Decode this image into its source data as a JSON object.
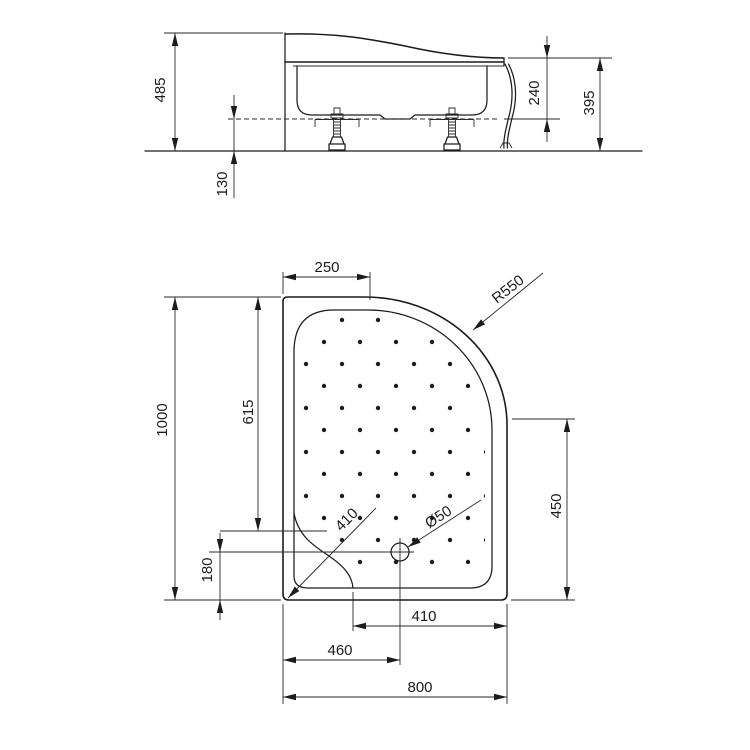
{
  "colors": {
    "line": "#1c1c1c",
    "background": "#ffffff"
  },
  "side_view": {
    "dim_overall_height": "485",
    "dim_rim_to_base": "240",
    "dim_apron_height": "395",
    "dim_floor_clearance": "130"
  },
  "plan_view": {
    "dim_top_straight": "250",
    "dim_corner_radius": "R550",
    "dim_length": "1000",
    "dim_seat_from_top": "615",
    "dim_right_straight": "450",
    "dim_diagonal": "410",
    "dim_drain_diameter": "Ø50",
    "dim_drain_to_bottom": "180",
    "dim_drain_to_right": "410",
    "dim_drain_from_left": "460",
    "dim_width": "800"
  }
}
